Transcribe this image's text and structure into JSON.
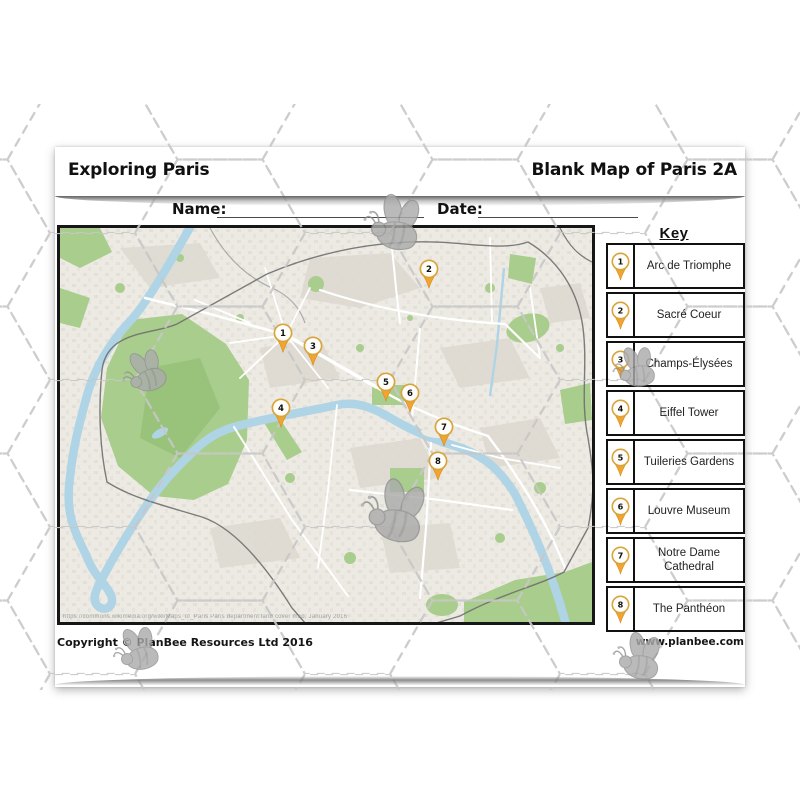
{
  "header": {
    "left_title": "Exploring Paris",
    "right_title": "Blank Map of Paris 2A"
  },
  "form": {
    "name_label": "Name:",
    "date_label": "Date:"
  },
  "key": {
    "title": "Key",
    "items": [
      {
        "number": "1",
        "label": "Arc de Triomphe"
      },
      {
        "number": "2",
        "label": "Sacré Coeur"
      },
      {
        "number": "3",
        "label": "Champs-Élysées"
      },
      {
        "number": "4",
        "label": "Eiffel Tower"
      },
      {
        "number": "5",
        "label": "Tuileries Gardens"
      },
      {
        "number": "6",
        "label": "Louvre Museum"
      },
      {
        "number": "7",
        "label": "Notre Dame Cathedral"
      },
      {
        "number": "8",
        "label": "The Panthéon"
      }
    ]
  },
  "map": {
    "attribution": "https://commons.wikimedia.org/wiki/Maps_of_Paris   Paris department land cover map,  January 2016",
    "pins": [
      {
        "number": "1",
        "x_pct": 41.9,
        "y_pct": 26.7
      },
      {
        "number": "2",
        "x_pct": 69.4,
        "y_pct": 10.4
      },
      {
        "number": "3",
        "x_pct": 47.6,
        "y_pct": 30.0
      },
      {
        "number": "4",
        "x_pct": 41.5,
        "y_pct": 45.7
      },
      {
        "number": "5",
        "x_pct": 61.3,
        "y_pct": 39.1
      },
      {
        "number": "6",
        "x_pct": 65.8,
        "y_pct": 41.9
      },
      {
        "number": "7",
        "x_pct": 72.2,
        "y_pct": 50.5
      },
      {
        "number": "8",
        "x_pct": 71.1,
        "y_pct": 59.1
      }
    ]
  },
  "footer": {
    "copyright": "Copyright © PlanBee Resources Ltd 2016",
    "website": "www.planbee.com"
  },
  "colors": {
    "pin_fill": "#F2A42E",
    "pin_ring": "#D8A43C",
    "river": "#AFD4E6",
    "park": "#A9CD8C",
    "map_bg": "#ECEAE3",
    "hex_dash": "#C7C7C7",
    "bee_gray": "#ABABAB"
  }
}
